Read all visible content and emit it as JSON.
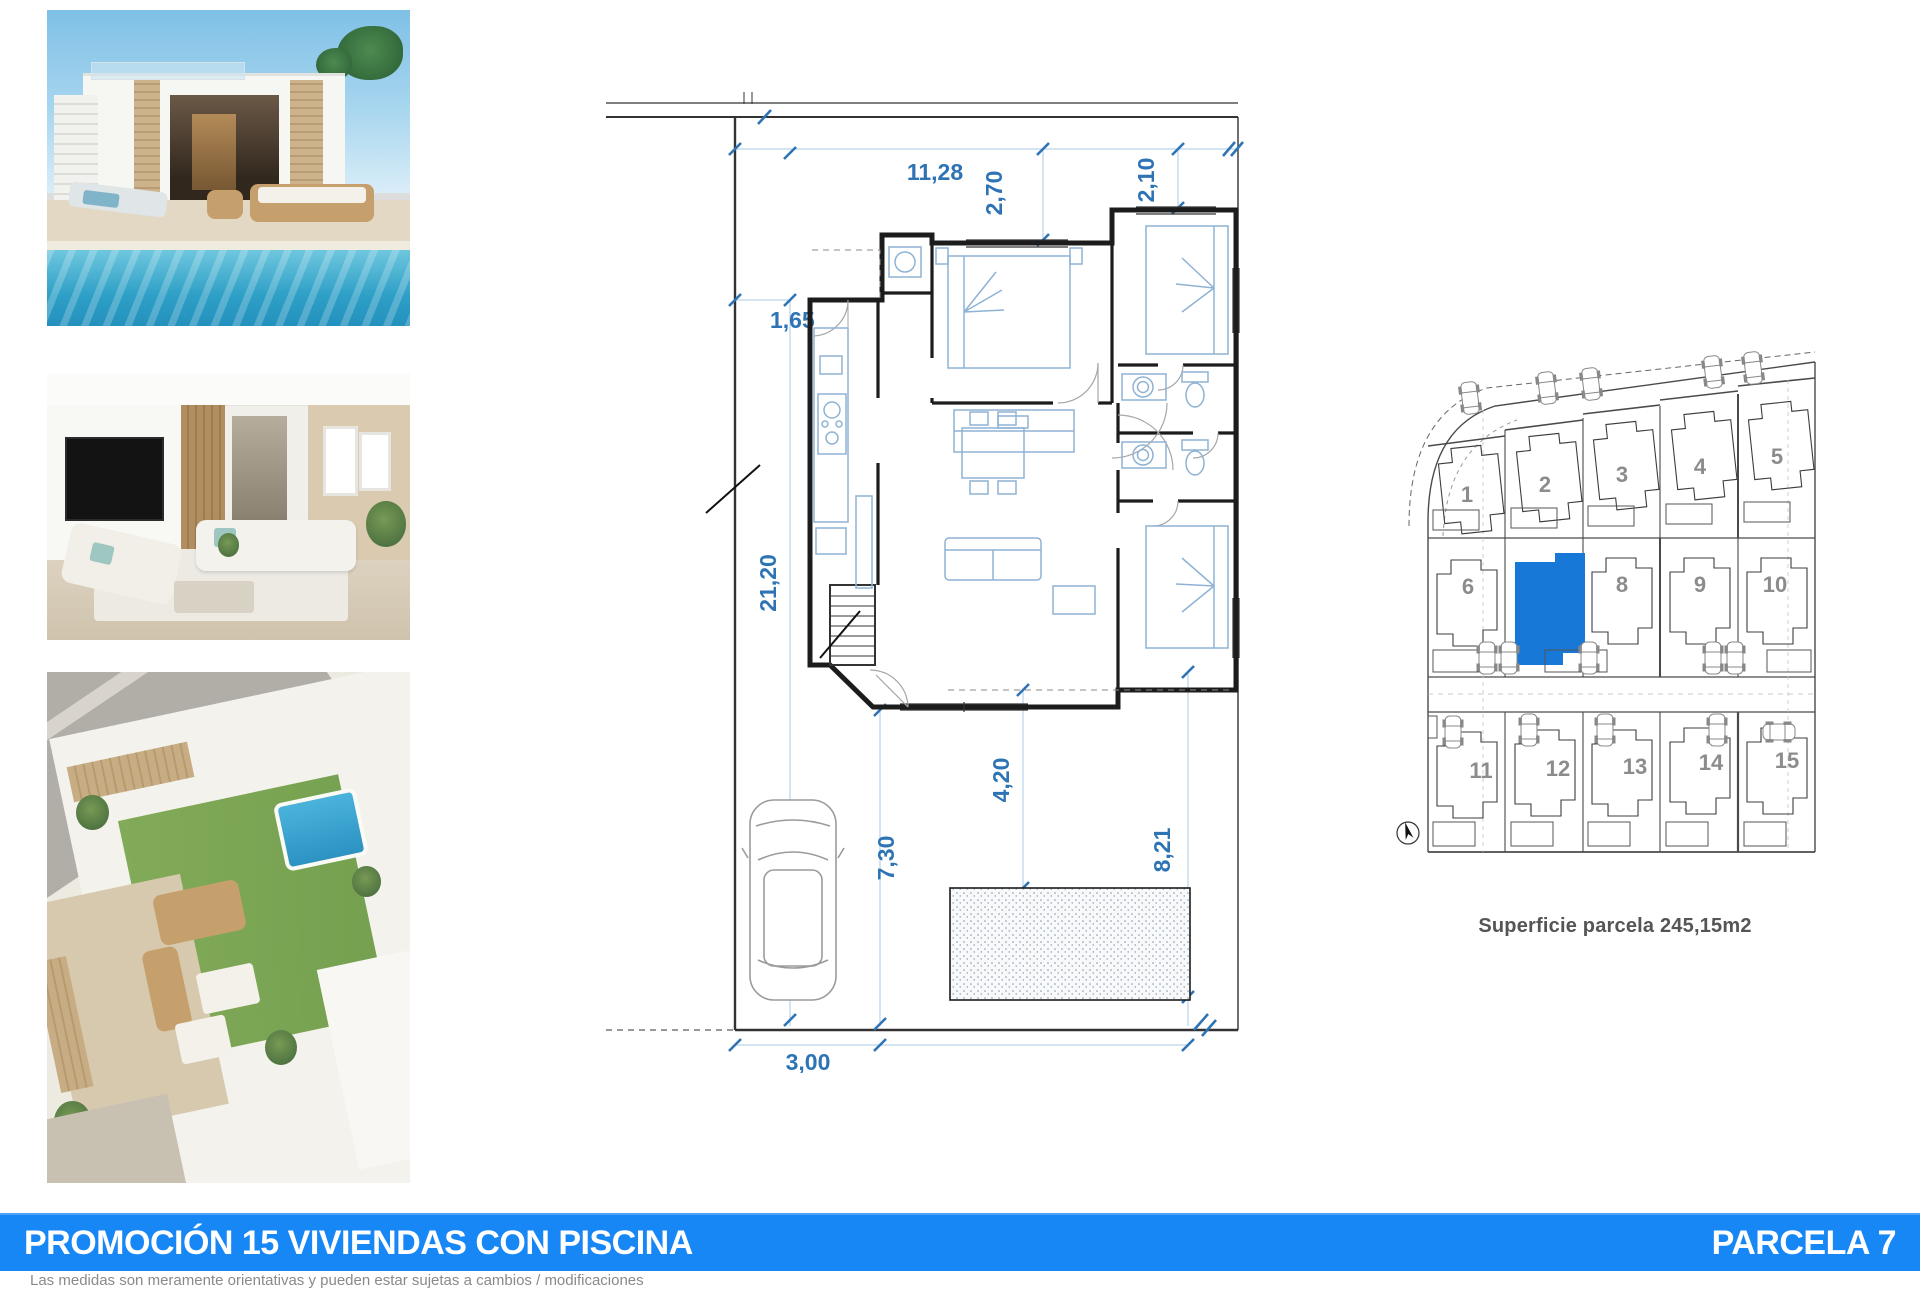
{
  "document": {
    "footer": {
      "title": "PROMOCIÓN 15 VIVIENDAS CON PISCINA",
      "parcel_label": "PARCELA 7",
      "bar_color": "#1787f5",
      "disclaimer": "Las medidas son meramente orientativas y pueden estar sujetas a cambios / modificaciones"
    },
    "floor_plan": {
      "dim_color": "#2e74b5",
      "dimensions": {
        "plot_width": "11,28",
        "depth_right_a": "2,70",
        "depth_right_b": "2,10",
        "setback_left": "1,65",
        "plot_depth": "21,20",
        "terrace_depth": "4,20",
        "garden_depth_left": "7,30",
        "garden_depth_right": "8,21",
        "pool_size": "6,00x 2,50",
        "driveway_width": "3,00"
      }
    },
    "site_plan": {
      "area_label": "Superficie parcela 245,15m2",
      "highlighted_plot": "7",
      "highlight_color": "#1878d8",
      "plot_numbers": [
        "1",
        "2",
        "3",
        "4",
        "5",
        "6",
        "8",
        "9",
        "10",
        "11",
        "12",
        "13",
        "14",
        "15"
      ]
    },
    "photos": [
      {
        "name": "villa-exterior-with-pool"
      },
      {
        "name": "living-room-interior"
      },
      {
        "name": "aerial-rooftop-terrace"
      }
    ]
  }
}
